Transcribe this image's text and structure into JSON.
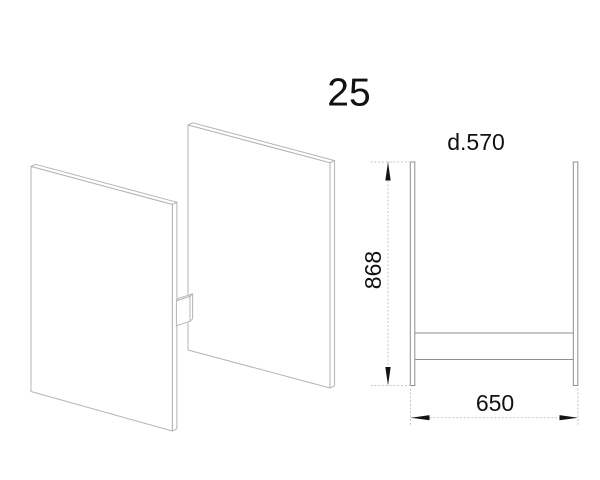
{
  "labels": {
    "part_number": "25",
    "depth": "d.570",
    "height": "868",
    "width": "650"
  },
  "colors": {
    "background": "#ffffff",
    "panel_outline": "#b4b4b4",
    "elevation_outline": "#8e8e8e",
    "rail_outline": "#9a9a9a",
    "dimension_line": "#c5c5c5",
    "arrow": "#141414",
    "text": "#111111"
  }
}
